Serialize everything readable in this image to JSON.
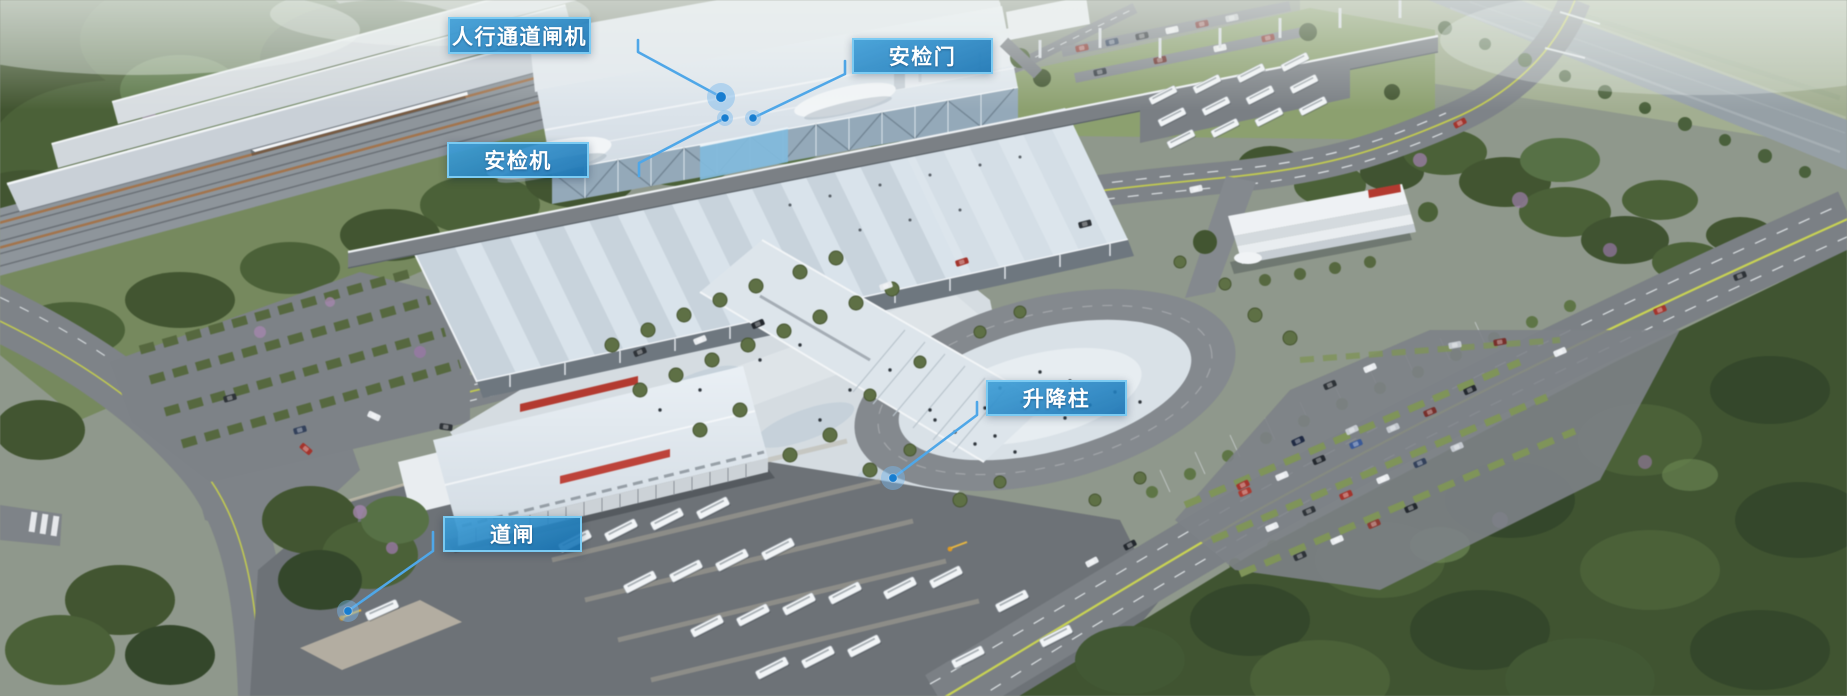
{
  "labels": [
    {
      "id": "pedestrian-gate",
      "text": "人行通道闸机"
    },
    {
      "id": "security-door",
      "text": "安检门"
    },
    {
      "id": "security-scanner",
      "text": "安检机"
    },
    {
      "id": "lift-bollard",
      "text": "升降柱"
    },
    {
      "id": "road-barrier",
      "text": "道闸"
    }
  ],
  "style": {
    "label_fill_top": "rgba(62,158,215,0.92)",
    "label_fill_bottom": "rgba(18,112,178,0.88)",
    "label_border": "rgba(126,205,244,0.95)",
    "label_text": "#ffffff",
    "callout_line": "#4fa7e8",
    "dot_fill": "#177dd0",
    "dot_halo": "rgba(120,185,238,0.45)"
  }
}
